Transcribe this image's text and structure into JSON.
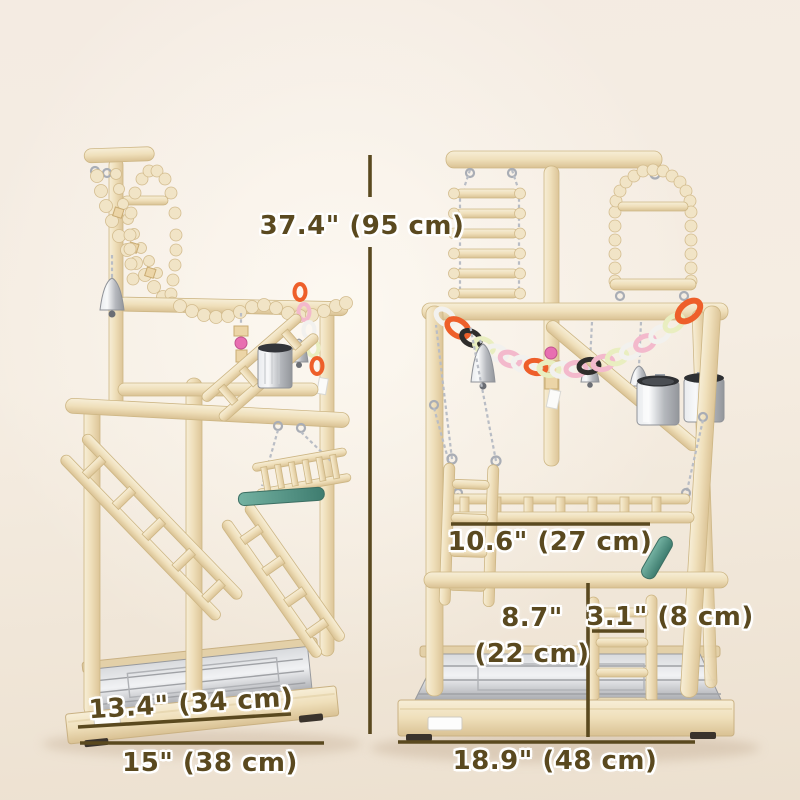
{
  "dimension_labels": {
    "overall_height": "37.4\" (95 cm)",
    "platform_width": "10.6\" (27 cm)",
    "ladder_height": "8.7\"",
    "ladder_height_cm": "(22 cm)",
    "ladder_width": "3.1\" (8 cm)",
    "tray_width": "13.4\" (34 cm)",
    "base_depth_left": "15\" (38 cm)",
    "base_width_right": "18.9\" (48 cm)"
  },
  "colors": {
    "dimension_accent": "#5a491f",
    "background": "#f4ebe0",
    "wood": "#f0e2c2",
    "teal_perch": "#4f8f80",
    "steel": "#c3c5c9",
    "chain_orange": "#ee5f2a",
    "chain_pink": "#f3b9cc",
    "chain_black": "#2f2d2b",
    "chain_green": "#e9eec0",
    "chain_white": "#f2f1ee",
    "bead_pink": "#e86fb1"
  }
}
